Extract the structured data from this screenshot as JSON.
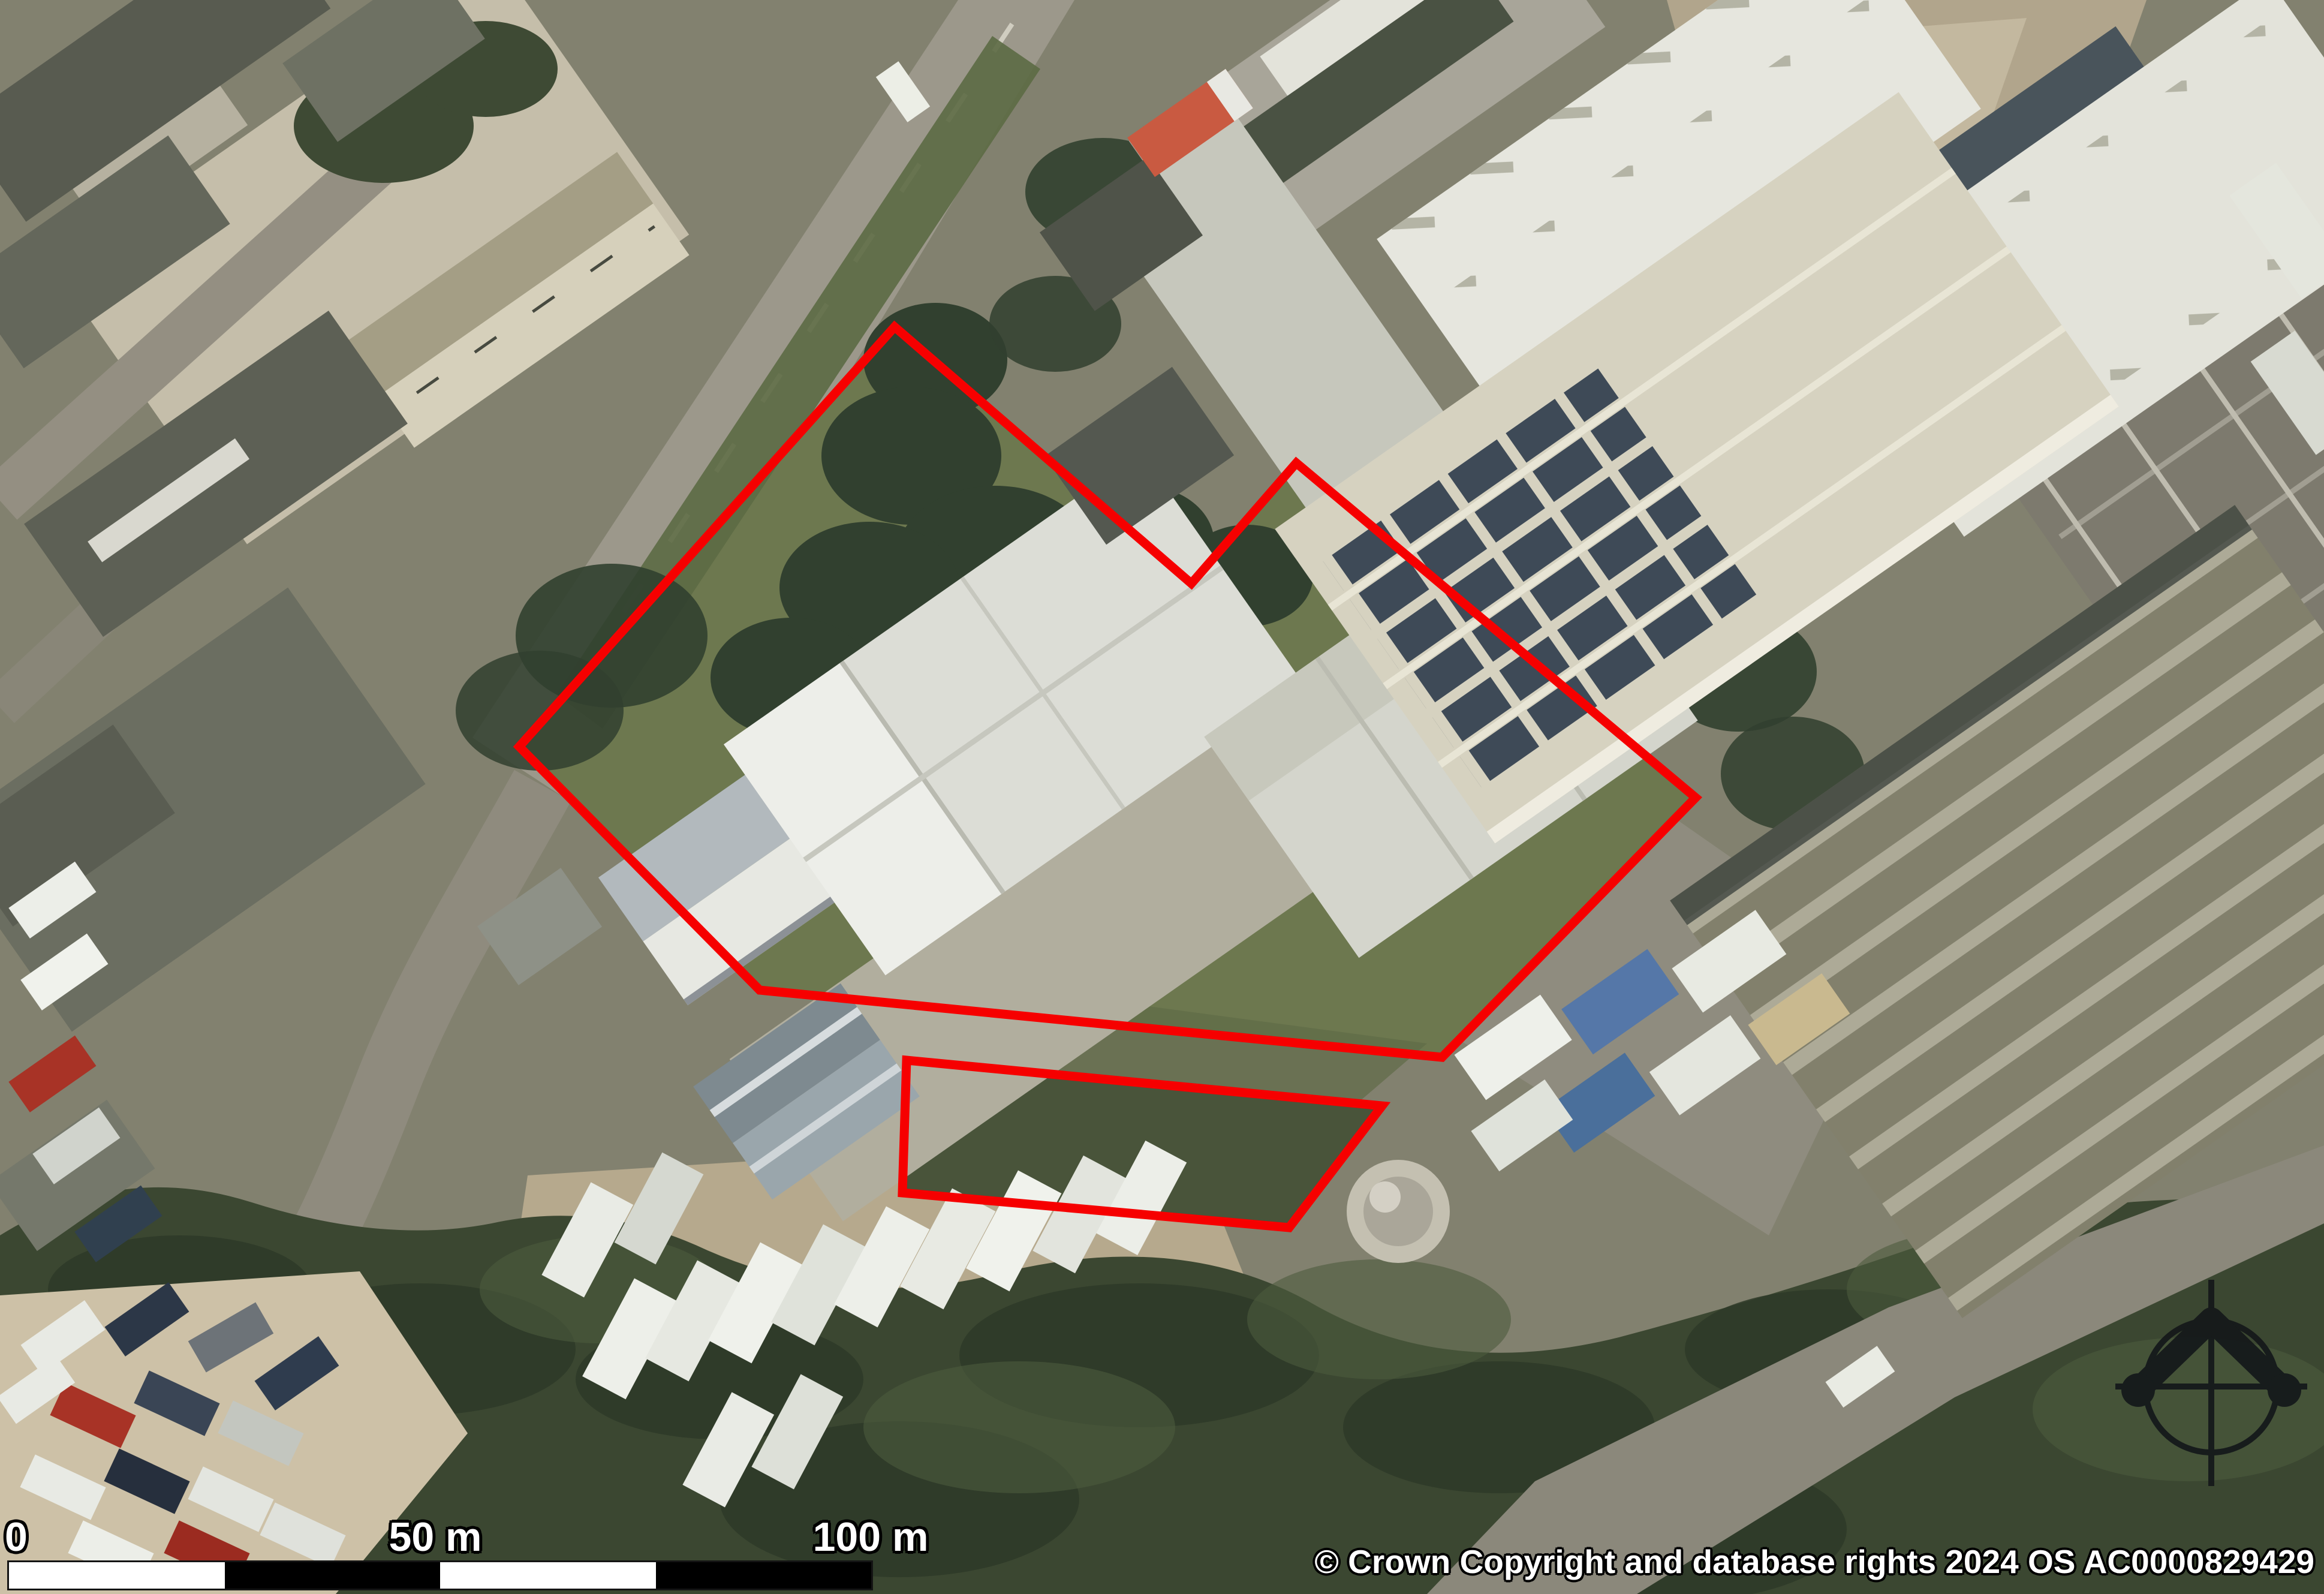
{
  "map": {
    "kind": "aerial-imagery-site-location-plan",
    "copyright": "© Crown Copyright and database rights 2024 OS AC0000829429",
    "scale_bar": {
      "labels": {
        "zero": "0",
        "fifty": "50 m",
        "hundred": "100 m"
      }
    },
    "compass": {
      "icon": "north-arrow-icon"
    },
    "boundaries": {
      "color": "#f60000",
      "main_site_points": "1492,545 1987,973 2162,772 2828,1330 2405,1763 1267,1651 866,1245",
      "detached_parcel_points": "1512,1768 2305,1844 2150,2047 1505,1989"
    }
  }
}
